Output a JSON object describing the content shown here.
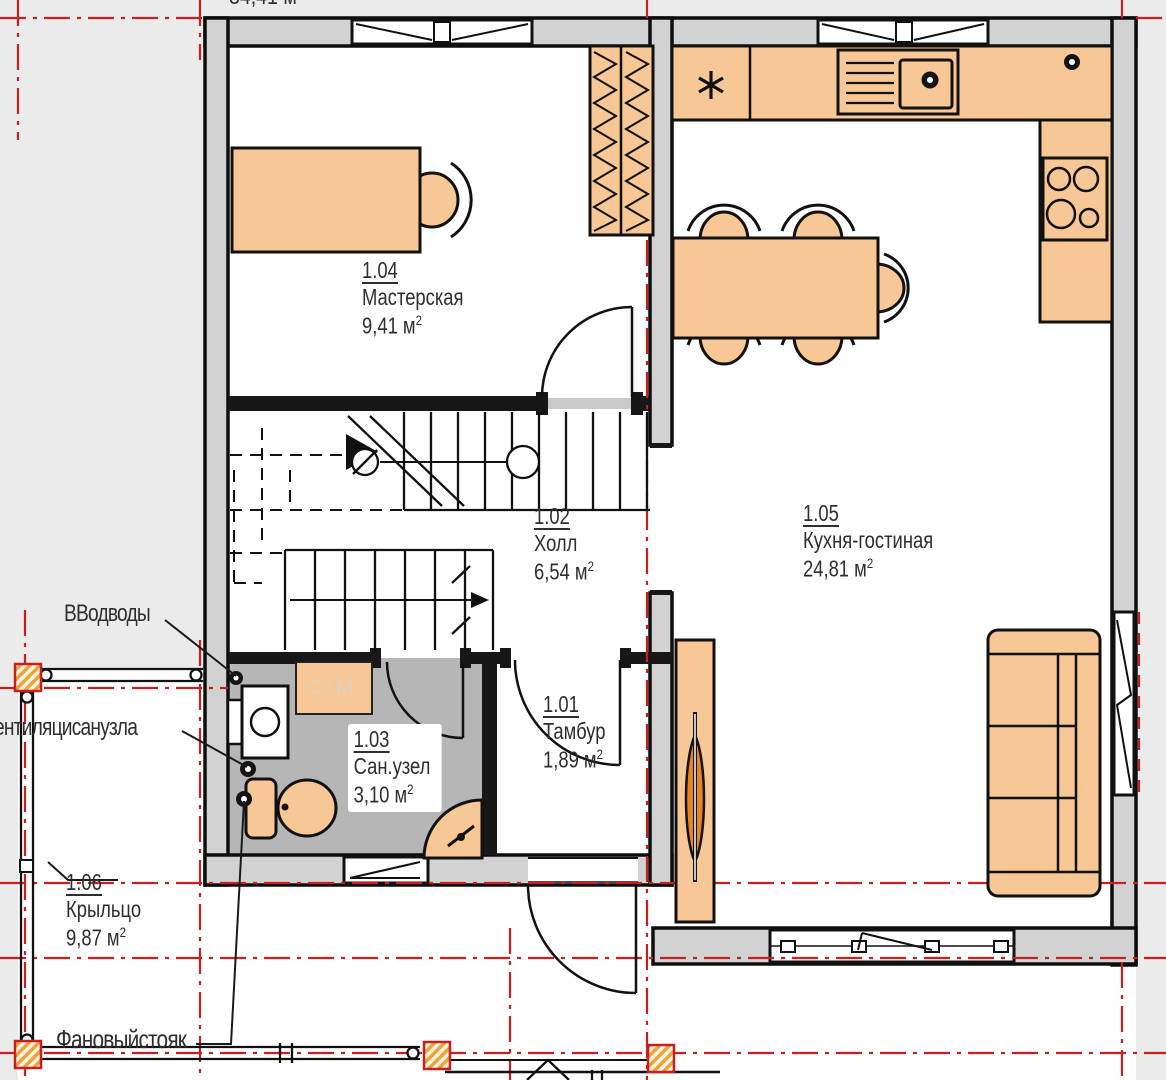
{
  "plan": {
    "top_partial_text": "34,41 м",
    "sup2": "2",
    "rooms": {
      "r101": {
        "num": "1.01",
        "name": "Тамбур",
        "area": "1,89 м"
      },
      "r102": {
        "num": "1.02",
        "name": "Холл",
        "area": "6,54 м"
      },
      "r103": {
        "num": "1.03",
        "name": "Сан.узел",
        "area": "3,10 м"
      },
      "r104": {
        "num": "1.04",
        "name": "Мастерская",
        "area": "9,41 м"
      },
      "r105": {
        "num": "1.05",
        "name": "Кухня-гостиная",
        "area": "24,81 м"
      },
      "r106": {
        "num": "1.06",
        "name": "Крыльцо",
        "area": "9,87 м"
      }
    },
    "annotations": {
      "water_inlet": "ВВодводы",
      "bath_vent": "ентиляцисанузла",
      "sewer_riser": "Фановыйстояк",
      "washing_machine": "Ст.М."
    },
    "colors": {
      "furniture_fill": "#f7c795",
      "plant_leaf": "#e8861c",
      "axis_red": "#c82020",
      "wall_fill": "#d2d2d2",
      "bath_floor": "#b6b6b6",
      "post_hatch": "#eaa43c",
      "line_black": "#111111",
      "label_text": "#2e2e2e",
      "washing_machine_text": "#dbd2c2"
    }
  }
}
